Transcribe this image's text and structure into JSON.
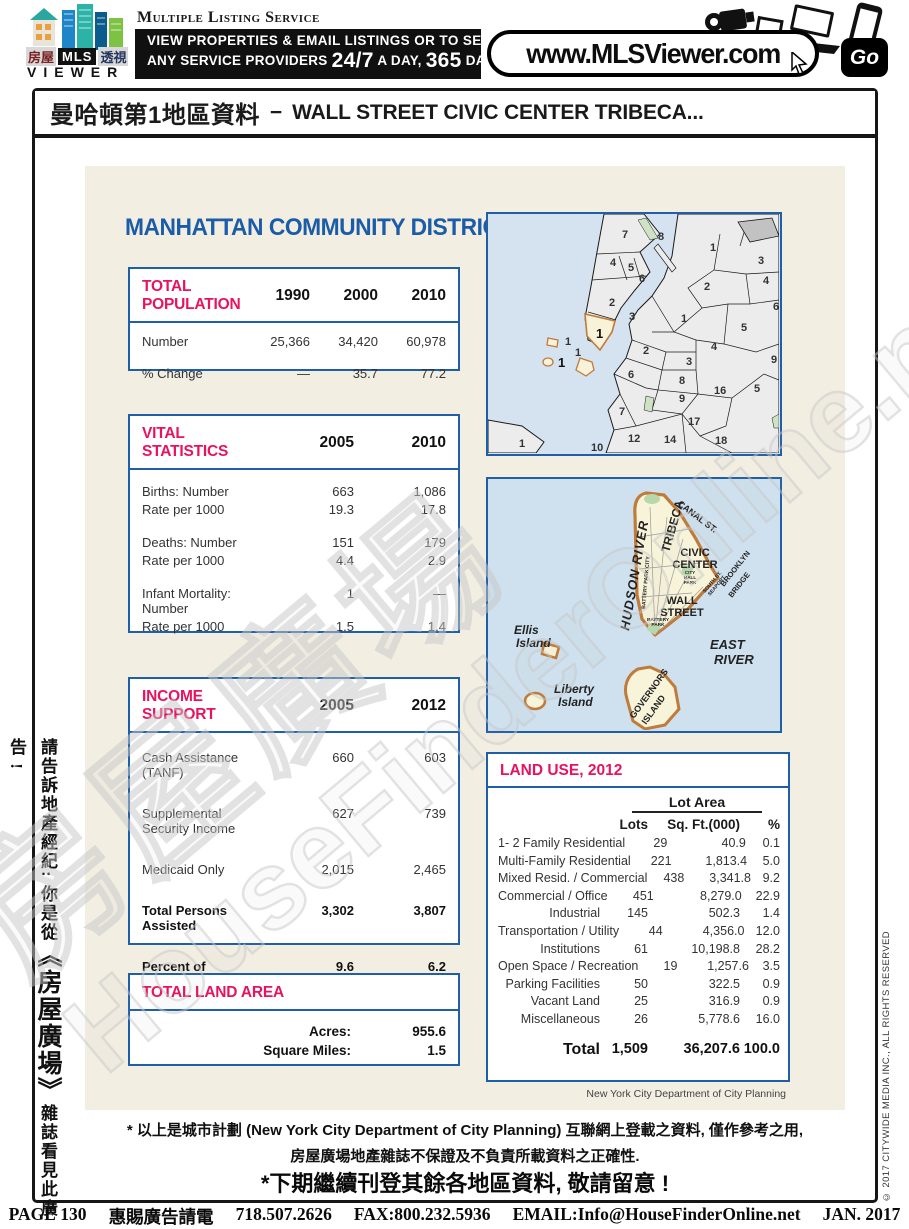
{
  "header": {
    "logo": {
      "cn_left": "房屋",
      "mls": "MLS",
      "cn_right": "透視",
      "viewer": "VIEWER"
    },
    "service_name": "Multiple Listing Service",
    "banner": {
      "line1": "VIEW PROPERTIES & EMAIL LISTINGS OR TO SEARCH",
      "line2_pre": "ANY SERVICE PROVIDERS",
      "b247": "24/7",
      "a_day": "A DAY,",
      "b365": "365",
      "days": "DAYS"
    },
    "url": "www.MLSViewer.com",
    "go": "Go"
  },
  "title_bar": {
    "cn": "曼哈頓第1地區資料",
    "dash": "−",
    "en": "WALL STREET CIVIC CENTER TRIBECA..."
  },
  "heading": "MANHATTAN COMMUNITY DISTRICT 1",
  "population": {
    "title": "TOTAL POPULATION",
    "years": [
      "1990",
      "2000",
      "2010"
    ],
    "rows": [
      {
        "label": "Number",
        "values": [
          "25,366",
          "34,420",
          "60,978"
        ]
      },
      {
        "label": "% Change",
        "values": [
          "—",
          "35.7",
          "77.2"
        ]
      }
    ]
  },
  "vital": {
    "title": "VITAL STATISTICS",
    "years": [
      "2005",
      "2010"
    ],
    "rows": [
      {
        "label": "Births: Number",
        "values": [
          "663",
          "1,086"
        ]
      },
      {
        "label": "Rate per 1000",
        "values": [
          "19.3",
          "17.8"
        ]
      },
      {
        "label": "Deaths: Number",
        "values": [
          "151",
          "179"
        ]
      },
      {
        "label": "Rate per 1000",
        "values": [
          "4.4",
          "2.9"
        ]
      },
      {
        "label": "Infant Mortality: Number",
        "values": [
          "1",
          "—"
        ]
      },
      {
        "label": "Rate per 1000",
        "values": [
          "1.5",
          "1.4"
        ]
      }
    ]
  },
  "income": {
    "title": "INCOME SUPPORT",
    "years": [
      "2005",
      "2012"
    ],
    "rows": [
      {
        "label": "Cash Assistance (TANF)",
        "values": [
          "660",
          "603"
        ]
      },
      {
        "label": "Supplemental Security Income",
        "values": [
          "627",
          "739"
        ]
      },
      {
        "label": "Medicaid Only",
        "values": [
          "2,015",
          "2,465"
        ]
      },
      {
        "label": "Total Persons Assisted",
        "values": [
          "3,302",
          "3,807"
        ]
      },
      {
        "label": "Percent of Population",
        "values": [
          "9.6",
          "6.2"
        ]
      }
    ]
  },
  "land_area": {
    "title": "TOTAL LAND AREA",
    "rows": [
      {
        "label": "Acres:",
        "value": "955.6"
      },
      {
        "label": "Square Miles:",
        "value": "1.5"
      }
    ]
  },
  "land_use": {
    "title": "LAND USE, 2012",
    "lot_area_header": "Lot Area",
    "col_lots": "Lots",
    "col_sqft": "Sq. Ft.(000)",
    "col_pct": "%",
    "rows": [
      {
        "label": "1- 2 Family Residential",
        "lots": "29",
        "sqft": "40.9",
        "pct": "0.1"
      },
      {
        "label": "Multi-Family Residential",
        "lots": "221",
        "sqft": "1,813.4",
        "pct": "5.0"
      },
      {
        "label": "Mixed Resid. / Commercial",
        "lots": "438",
        "sqft": "3,341.8",
        "pct": "9.2"
      },
      {
        "label": "Commercial / Office",
        "lots": "451",
        "sqft": "8,279.0",
        "pct": "22.9"
      },
      {
        "label": "Industrial",
        "lots": "145",
        "sqft": "502.3",
        "pct": "1.4"
      },
      {
        "label": "Transportation / Utility",
        "lots": "44",
        "sqft": "4,356.0",
        "pct": "12.0"
      },
      {
        "label": "Institutions",
        "lots": "61",
        "sqft": "10,198.8",
        "pct": "28.2"
      },
      {
        "label": "Open Space / Recreation",
        "lots": "19",
        "sqft": "1,257.6",
        "pct": "3.5"
      },
      {
        "label": "Parking Facilities",
        "lots": "50",
        "sqft": "322.5",
        "pct": "0.9"
      },
      {
        "label": "Vacant Land",
        "lots": "25",
        "sqft": "316.9",
        "pct": "0.9"
      },
      {
        "label": "Miscellaneous",
        "lots": "26",
        "sqft": "5,778.6",
        "pct": "16.0"
      }
    ],
    "total": {
      "label": "Total",
      "lots": "1,509",
      "sqft": "36,207.6",
      "pct": "100.0"
    },
    "source": "New York City Department of City Planning"
  },
  "maps": {
    "overview": {
      "labels": [
        "7",
        "8",
        "4",
        "5",
        "6",
        "2",
        "3",
        "1",
        "1",
        "1",
        "1",
        "1",
        "3",
        "2",
        "4",
        "1",
        "5",
        "6",
        "2",
        "3",
        "4",
        "9",
        "6",
        "8",
        "9",
        "16",
        "5",
        "7",
        "17",
        "12",
        "14",
        "18",
        "10",
        "1"
      ]
    },
    "detail": {
      "hudson": "HUDSON  RIVER",
      "tribeca": "TRIBECA",
      "canal": "CANAL ST.",
      "civic1": "CIVIC",
      "civic2": "CENTER",
      "ch1": "CITY",
      "ch2": "HALL",
      "ch3": "PARK",
      "bpc": "BATTERY PARK CITY",
      "wall1": "WALL",
      "wall2": "STREET",
      "sea1": "SOUTH ST.",
      "sea2": "SEAPORT",
      "bb1": "BROOKLYN",
      "bb2": "BRIDGE",
      "bp1": "BATTERY",
      "bp2": "PARK",
      "east1": "EAST",
      "east2": "RIVER",
      "ellis1": "Ellis",
      "ellis2": "Island",
      "lib1": "Liberty",
      "lib2": "Island",
      "gov1": "GOVERNORS",
      "gov2": "ISLAND"
    }
  },
  "watermark": {
    "line1": "房屋廣場",
    "line2": "HouseFinderOnline.net"
  },
  "disclaimer": {
    "line1": "* 以上是城市計劃 (New York City Department of City Planning) 互聯網上登載之資料, 僅作參考之用,",
    "line2": "房屋廣場地產雜誌不保證及不負責所載資料之正確性.",
    "notice": "*下期繼續刊登其餘各地區資料, 敬請留意 !"
  },
  "side_left": {
    "pre": "請告訴地產經紀: 你是從",
    "book": "《房屋廣場》",
    "post": "雜誌看見此廣告 !"
  },
  "side_right": "© 2017 CITYWIDE MEDIA INC., ALL RIGHTS RESERVED",
  "footer": {
    "page": "PAGE 130",
    "ad": "惠賜廣告請電",
    "phone": "718.507.2626",
    "fax": "FAX:800.232.5936",
    "email": "EMAIL:Info@HouseFinderOnline.net",
    "date": "JAN. 2017"
  },
  "colors": {
    "accent_pink": "#e9125f",
    "accent_blue": "#1e5fa7",
    "panel_beige": "#f2eee2"
  }
}
